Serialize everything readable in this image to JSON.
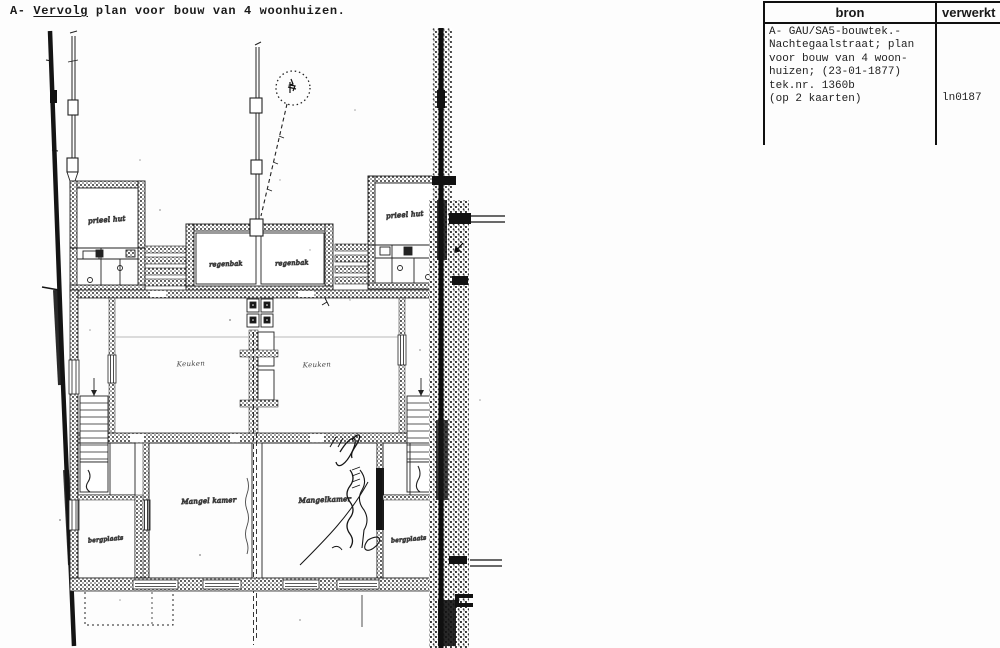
{
  "header": {
    "prefix": "A- ",
    "underlined": "Vervolg",
    "rest": " plan voor bouw van 4 woonhuizen."
  },
  "table": {
    "col_bron": "bron",
    "col_verwerkt": "verwerkt",
    "bron_lines": [
      "A- GAU/SA5-bouwtek.-",
      "Nachtegaalstraat; plan",
      "voor bouw van 4 woon-",
      "huizen; (23-01-1877)",
      "tek.nr. 1360b",
      "(op 2 kaarten)"
    ],
    "verwerkt_value": "ln0187"
  },
  "plan": {
    "ink_color": "#1c1c1c",
    "labels": {
      "prieel_left": "prieel hut",
      "prieel_right": "prieel hut",
      "regenbak_left": "regenbak",
      "regenbak_right": "regenbak",
      "keuken_left": "Keuken",
      "keuken_right": "Keuken",
      "mangel_left": "Mangel kamer",
      "mangel_right": "Mangelkamer",
      "bergplaats_left": "bergplaats",
      "bergplaats_right": "bergplaats"
    }
  }
}
